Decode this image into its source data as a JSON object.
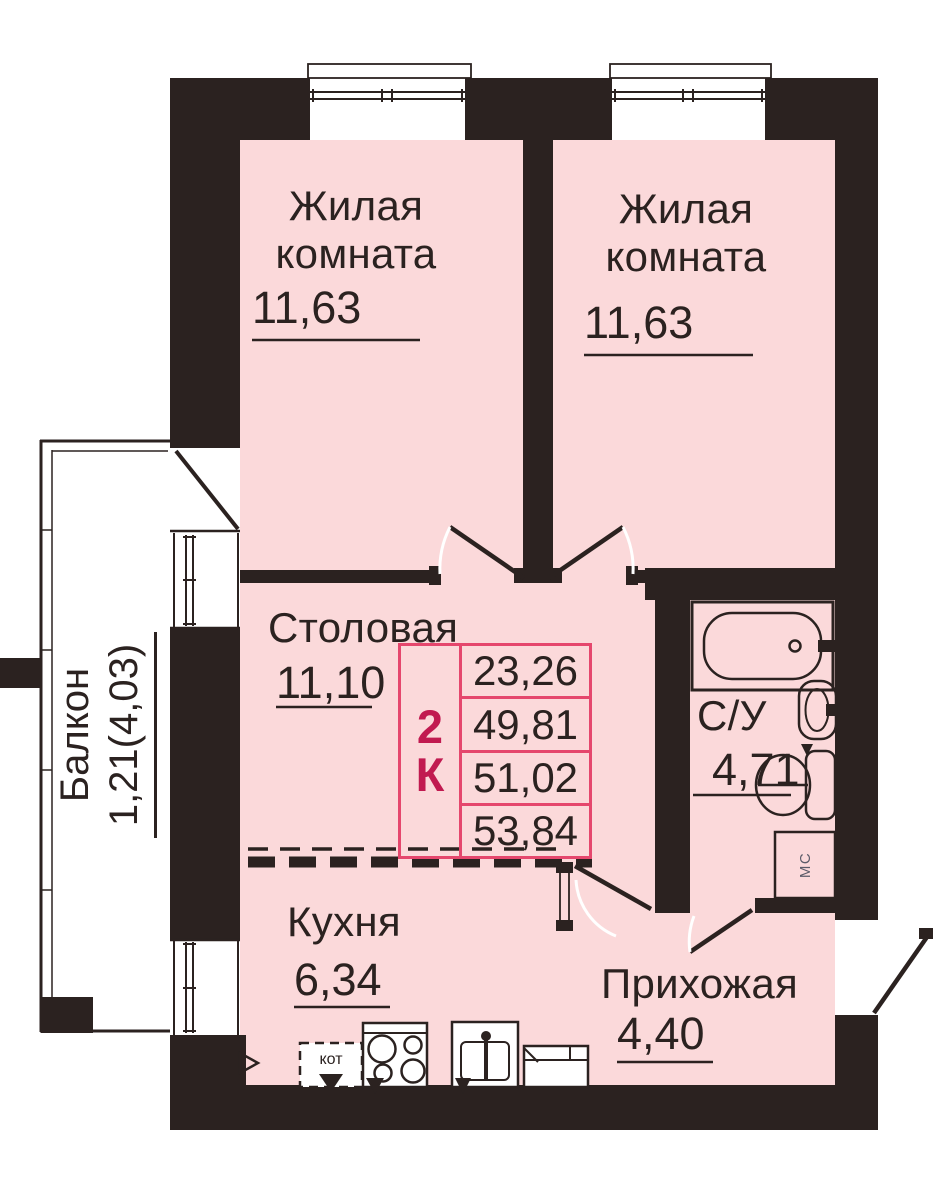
{
  "title": "Планировка квартиры 2К",
  "unit": {
    "rooms_count": "2",
    "rooms_letter": "К"
  },
  "areas_table": {
    "values": [
      "23,26",
      "49,81",
      "51,02",
      "53,84"
    ]
  },
  "rooms": {
    "living1": {
      "name": "Жилая комната",
      "area": "11,63"
    },
    "living2": {
      "name": "Жилая комната",
      "area": "11,63"
    },
    "dining": {
      "name": "Столовая",
      "area": "11,10"
    },
    "bathroom": {
      "name": "С/У",
      "area": "4,71"
    },
    "kitchen": {
      "name": "Кухня",
      "area": "6,34"
    },
    "hallway": {
      "name": "Прихожая",
      "area": "4,40"
    },
    "balcony": {
      "name": "Балкон",
      "area": "1,21(4,03)"
    }
  },
  "fixtures": {
    "washing_machine": "МС",
    "boiler": "кот"
  },
  "colors": {
    "wall": "#2b2220",
    "room_fill": "#fbd9da",
    "table_border": "#e5476d",
    "unit_text": "#c11a50",
    "text": "#2b2220",
    "background": "#ffffff"
  }
}
